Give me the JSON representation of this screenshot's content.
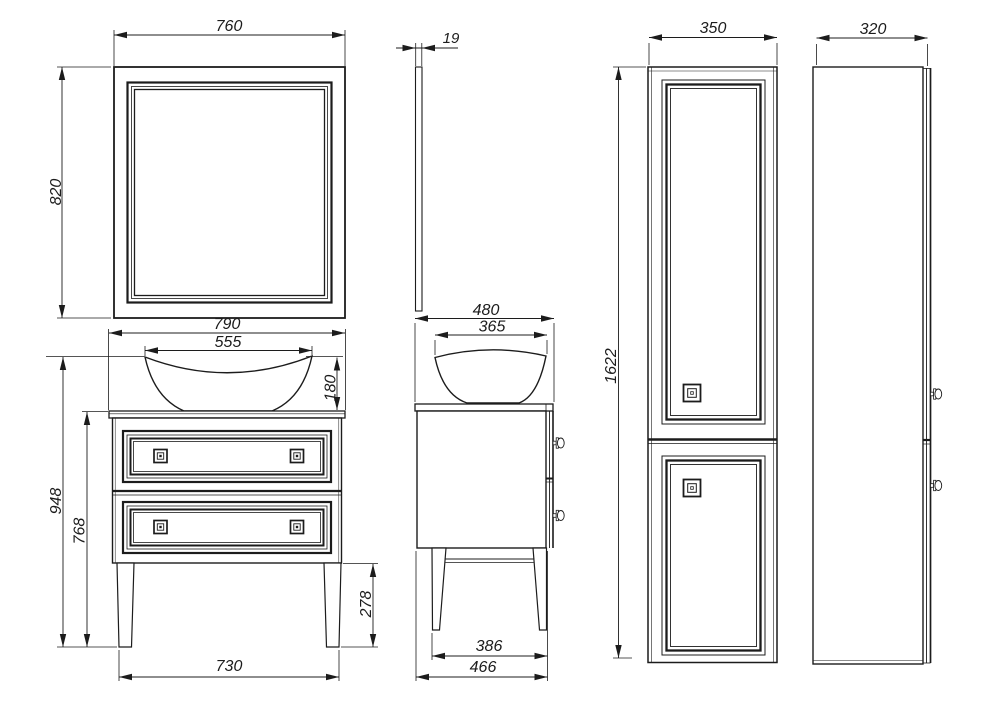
{
  "drawing": {
    "description": "Bathroom furniture orthographic technical drawing",
    "colors": {
      "line": "#1c1c1c",
      "background": "#ffffff"
    }
  },
  "views": {
    "mirror_front": {
      "width": "760",
      "height": "820"
    },
    "mirror_side": {
      "thickness": "19"
    },
    "washstand_front": {
      "countertop_width": "790",
      "basin_width": "555",
      "basin_height": "180",
      "total_height": "948",
      "cabinet_height": "768",
      "floor_clearance": "278",
      "leg_span": "730"
    },
    "washstand_side": {
      "countertop_depth": "480",
      "basin_depth": "365",
      "leg_span": "386",
      "base_depth": "466"
    },
    "column_front": {
      "width": "350",
      "height": "1622"
    },
    "column_side": {
      "depth": "320"
    }
  }
}
